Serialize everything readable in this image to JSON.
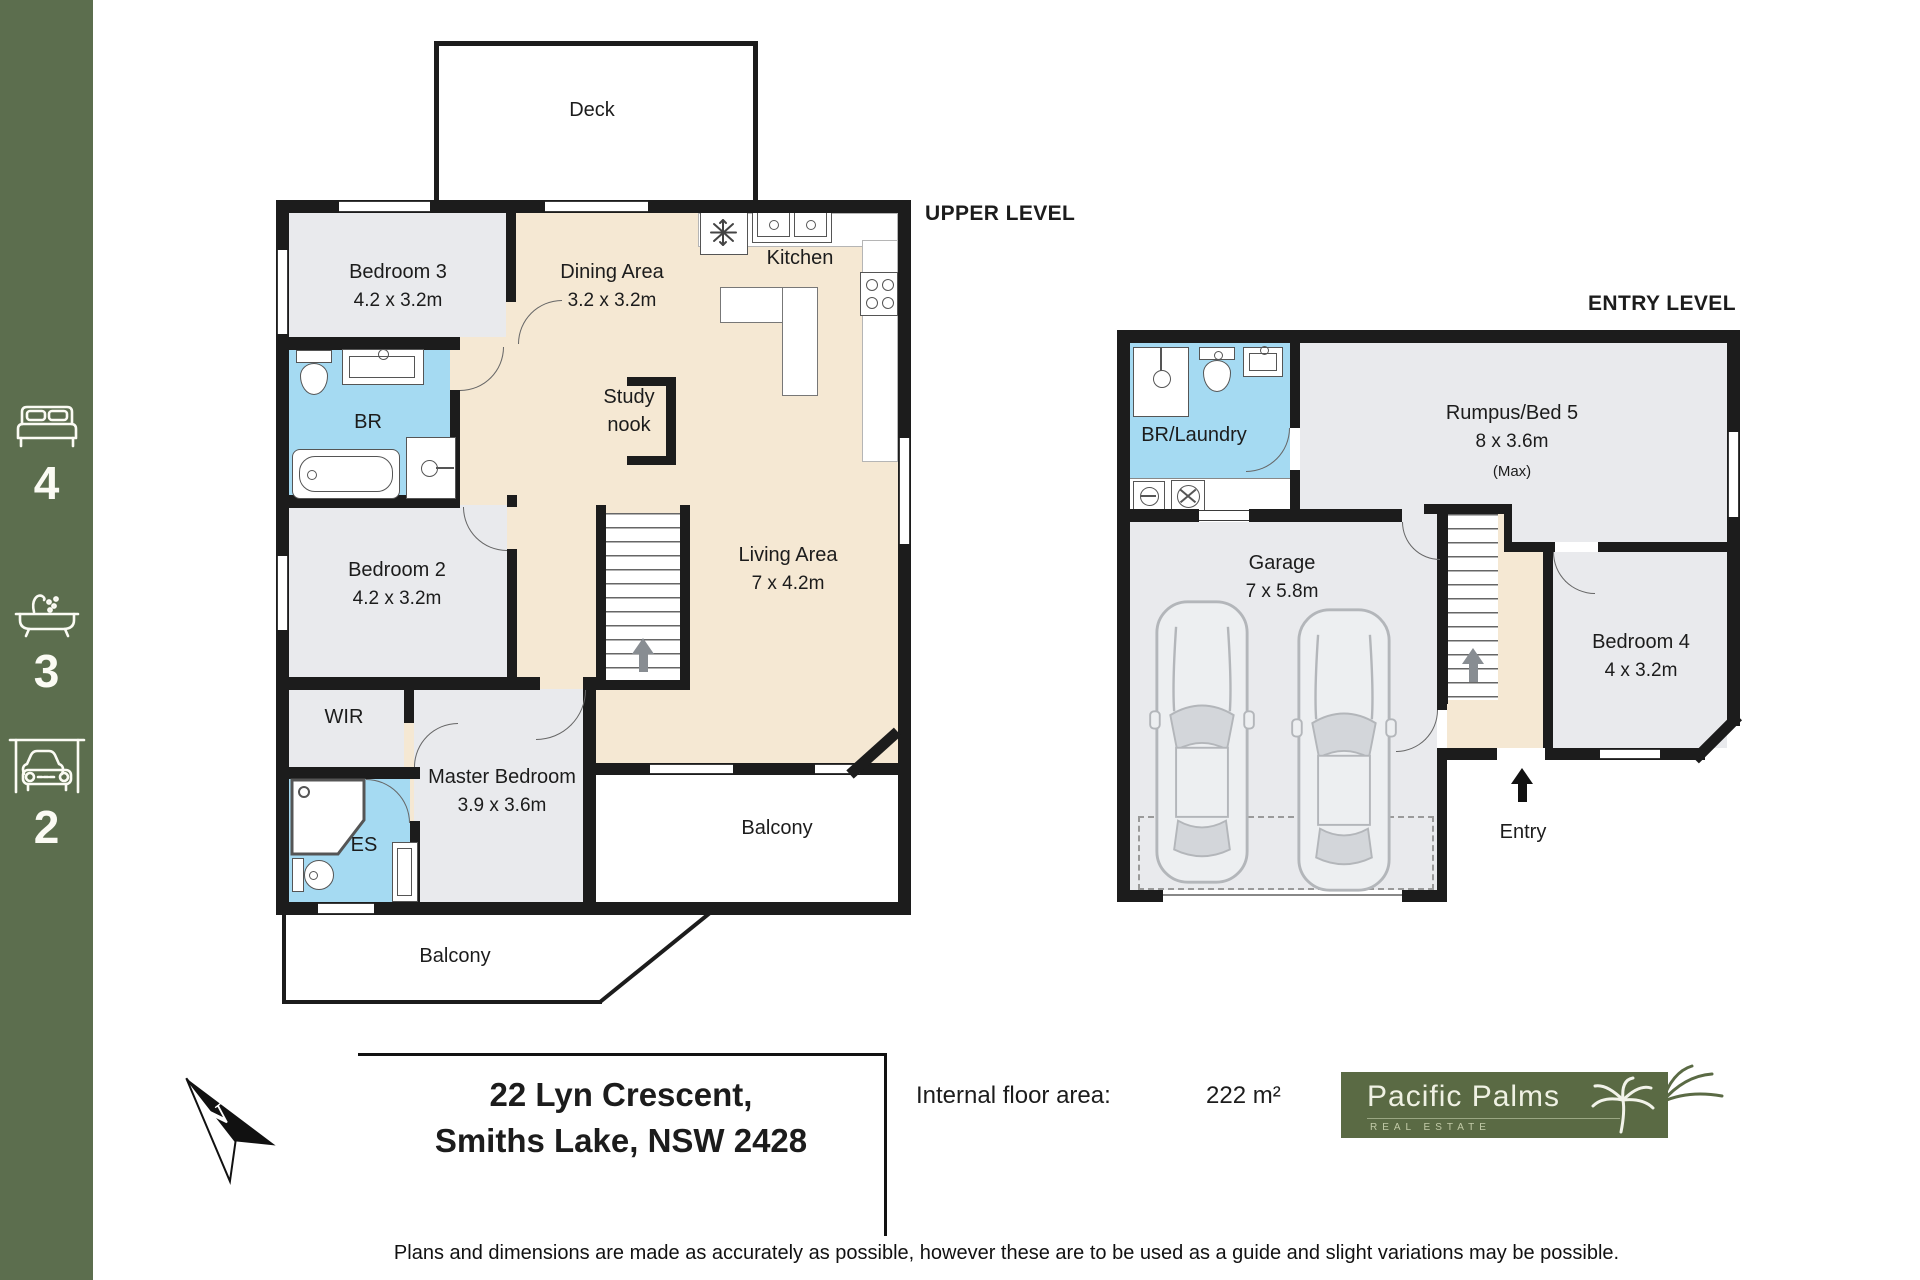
{
  "sidebar": {
    "stats": [
      {
        "icon": "bed-icon",
        "count": "4"
      },
      {
        "icon": "bath-icon",
        "count": "3"
      },
      {
        "icon": "car-icon",
        "count": "2"
      }
    ]
  },
  "upper_level": {
    "title": "UPPER LEVEL",
    "rooms": {
      "deck": {
        "name": "Deck"
      },
      "bedroom3": {
        "name": "Bedroom 3",
        "dims": "4.2 x 3.2m"
      },
      "dining": {
        "name": "Dining Area",
        "dims": "3.2 x 3.2m"
      },
      "kitchen": {
        "name": "Kitchen"
      },
      "br": {
        "name": "BR"
      },
      "study": {
        "line1": "Study",
        "line2": "nook"
      },
      "bedroom2": {
        "name": "Bedroom 2",
        "dims": "4.2 x 3.2m"
      },
      "living": {
        "name": "Living Area",
        "dims": "7 x 4.2m"
      },
      "wir": {
        "name": "WIR"
      },
      "master": {
        "name": "Master Bedroom",
        "dims": "3.9 x 3.6m"
      },
      "es": {
        "name": "ES"
      },
      "balcony_side": {
        "name": "Balcony"
      },
      "balcony_bottom": {
        "name": "Balcony"
      }
    }
  },
  "entry_level": {
    "title": "ENTRY LEVEL",
    "rooms": {
      "br_laundry": {
        "name": "BR/Laundry"
      },
      "rumpus": {
        "name": "Rumpus/Bed 5",
        "dims": "8 x 3.6m",
        "note": "(Max)"
      },
      "garage": {
        "name": "Garage",
        "dims": "7 x 5.8m"
      },
      "bedroom4": {
        "name": "Bedroom 4",
        "dims": "4 x 3.2m"
      },
      "entry": {
        "name": "Entry"
      }
    }
  },
  "footer": {
    "north_label": "N",
    "address_line1": "22 Lyn Crescent,",
    "address_line2": "Smiths Lake, NSW 2428",
    "floor_area_label": "Internal floor area:",
    "floor_area_value": "222 m²",
    "logo_name": "Pacific Palms",
    "logo_tagline": "REAL ESTATE",
    "disclaimer": "Plans and dimensions are made as accurately as possible, however these are to be used as a guide and slight variations may be possible."
  },
  "colors": {
    "sidebar_green": "#5c6e4e",
    "floor_beige": "#f5e8d3",
    "room_gray": "#e9eaed",
    "bath_blue": "#a5daf2",
    "wall_black": "#1c1c1c",
    "logo_green": "#5a6a44"
  }
}
